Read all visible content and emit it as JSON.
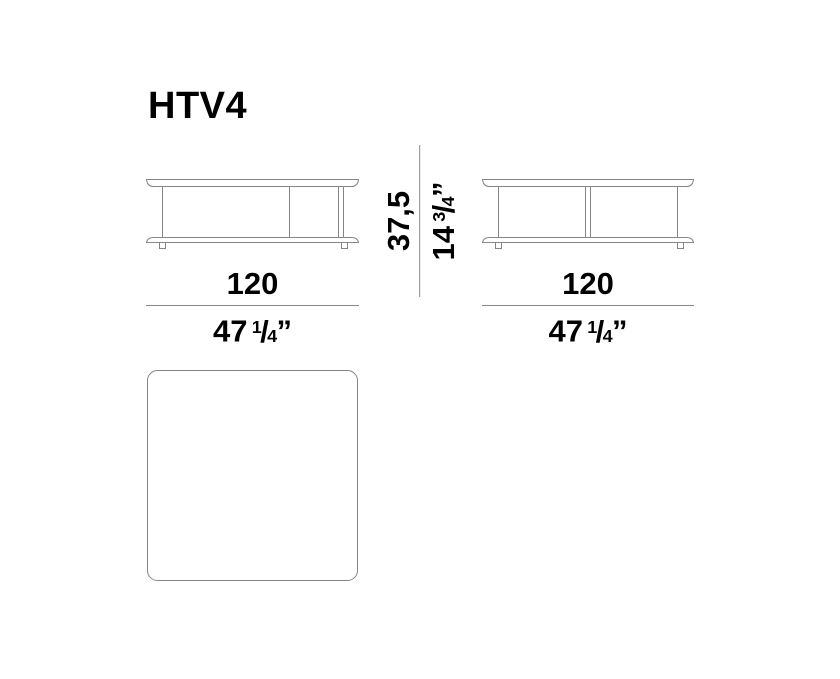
{
  "title": "HTV4",
  "drawing": {
    "stroke_color": "#858585",
    "dim_line_color": "#8a8a8a",
    "text_color": "#000000",
    "views": [
      "front-elevation",
      "side-elevation",
      "plan-view"
    ]
  },
  "dimensions": {
    "height": {
      "metric": "37,5",
      "imperial_whole": "14",
      "imperial_fraction_numerator": "3",
      "imperial_fraction_denominator": "4",
      "imperial_unit_mark": "”"
    },
    "front_width": {
      "metric": "120",
      "imperial_whole": "47",
      "imperial_fraction_numerator": "1",
      "imperial_fraction_denominator": "4",
      "imperial_unit_mark": "”"
    },
    "side_width": {
      "metric": "120",
      "imperial_whole": "47",
      "imperial_fraction_numerator": "1",
      "imperial_fraction_denominator": "4",
      "imperial_unit_mark": "”"
    }
  },
  "glyphs": {
    "fraction_slash": "/"
  }
}
